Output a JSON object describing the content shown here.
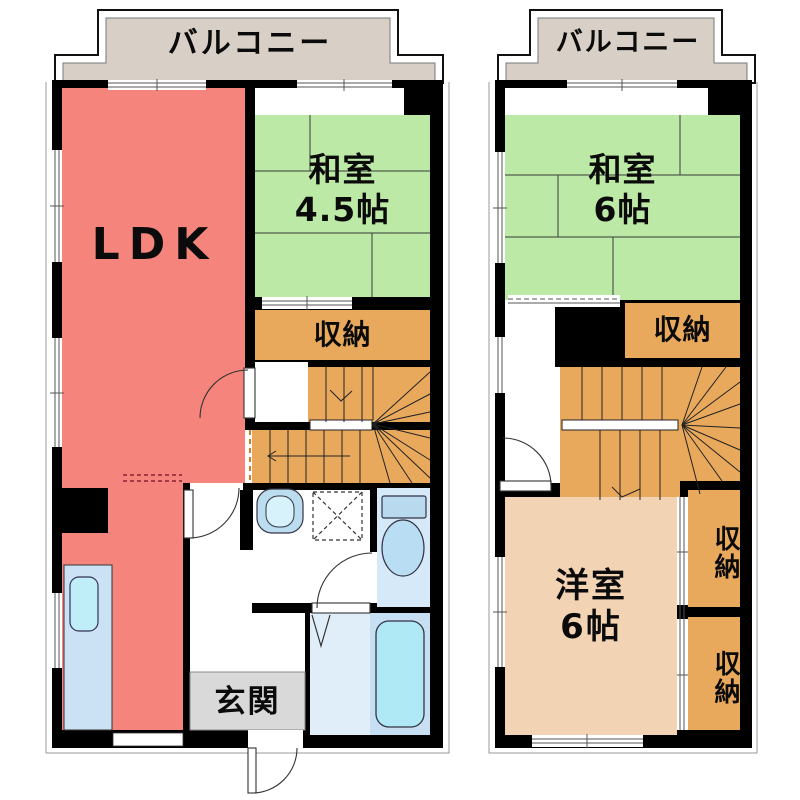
{
  "colors": {
    "balcony_fill": "#d8d0c6",
    "ldk_fill": "#f5847c",
    "tatami_fill": "#bce9a5",
    "storage_stairs_fill": "#e9a95d",
    "western_room_fill": "#f2d3b4",
    "entrance_fill": "#d9d9d9",
    "fixture_counter": "#cbe2f4",
    "fixture_basin": "#bfeef8",
    "bath_floor": "#e0eefa",
    "tub_zone": "#c6dff2",
    "tub_fill": "#b0e9f6",
    "toilet_room": "#d6e9f8",
    "wall": "#000000"
  },
  "left_plan": {
    "balcony": "バルコニー",
    "ldk": "LDK",
    "washitsu_name": "和室",
    "washitsu_size": "4.5帖",
    "storage": "収納",
    "entrance": "玄関"
  },
  "right_plan": {
    "balcony": "バルコニー",
    "washitsu_name": "和室",
    "washitsu_size": "6帖",
    "storage": "収納",
    "western_name": "洋室",
    "western_size": "6帖",
    "storage_upper": "収納",
    "storage_lower": "収納"
  }
}
